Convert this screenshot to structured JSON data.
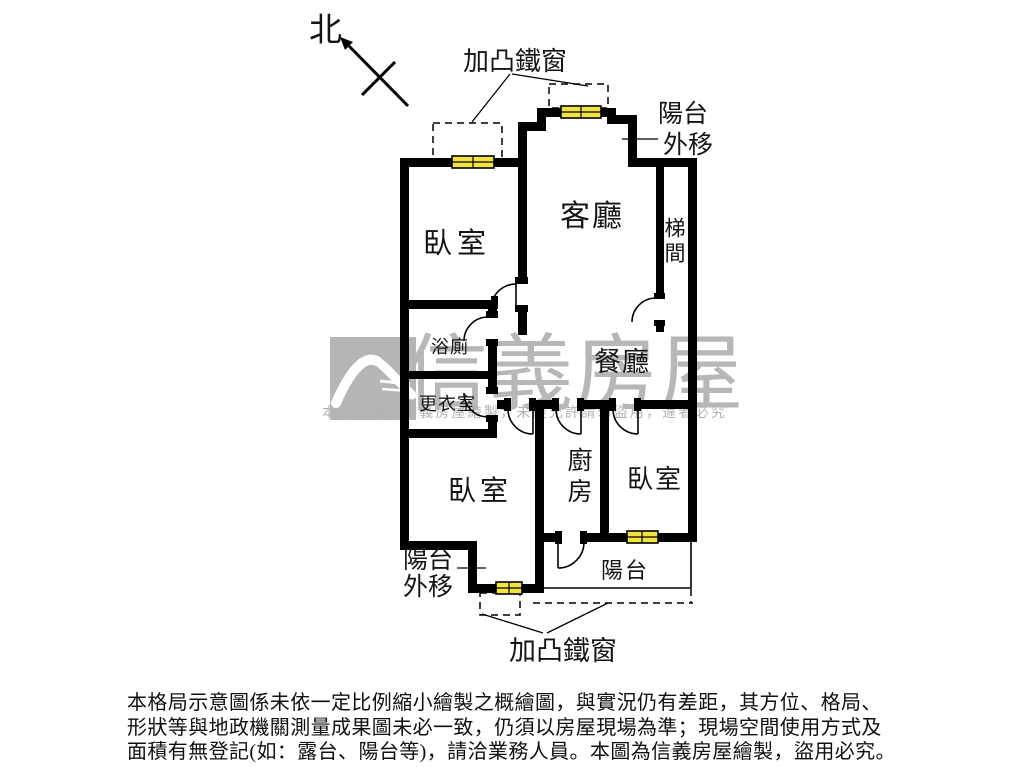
{
  "compass": {
    "north_label": "北"
  },
  "annotations": {
    "iron_window_top": "加凸鐵窗",
    "iron_window_bottom": "加凸鐵窗",
    "balcony_shift_top_line1": "陽台",
    "balcony_shift_top_line2": "外移",
    "balcony_shift_bottom_line1": "陽台",
    "balcony_shift_bottom_line2": "外移"
  },
  "rooms": {
    "living_room": "客廳",
    "dining_room": "餐廳",
    "bedroom_top_left": "臥室",
    "bedroom_bottom_left": "臥室",
    "bedroom_bottom_right": "臥室",
    "kitchen": "廚房",
    "bathroom": "浴廁",
    "dressing_room": "更衣室",
    "stairwell": "梯間",
    "balcony": "陽台"
  },
  "watermark": {
    "brand": "信義房屋",
    "notice": "本格局圖為信義房屋繪製，未經允許請勿盜用，違者必究"
  },
  "disclaimer": {
    "line1": "本格局示意圖係未依一定比例縮小繪製之概繪圖，與實況仍有差距，其方位、格局、",
    "line2": "形狀等與地政機關測量成果圖未必一致，仍須以房屋現場為準；現場空間使用方式及",
    "line3": "面積有無登記(如：露台、陽台等)，請洽業務人員。本圖為信義房屋繪製，盜用必究。"
  },
  "colors": {
    "wall": "#000000",
    "window_fill": "#f2e340",
    "watermark_gray": "#b7b7b7"
  }
}
